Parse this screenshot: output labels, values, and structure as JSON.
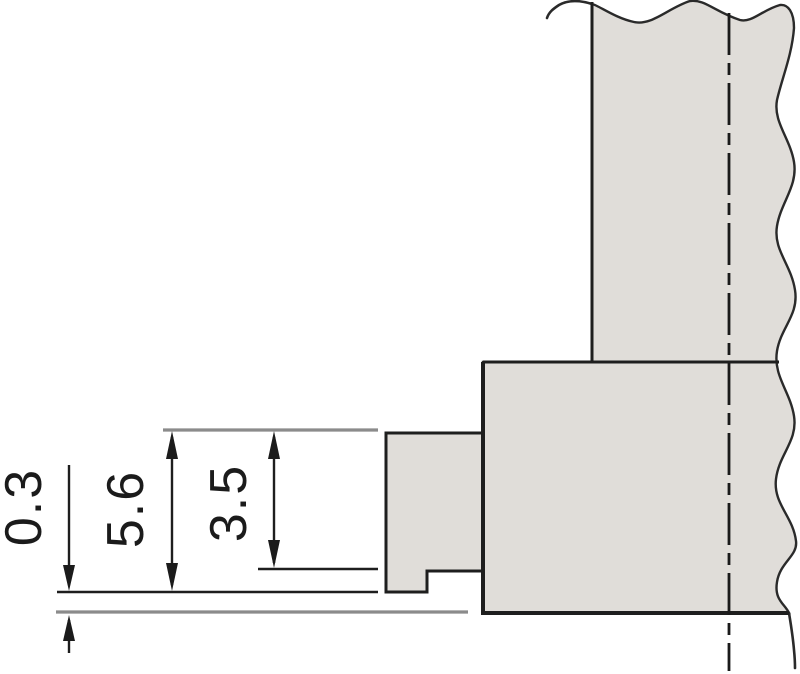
{
  "diagram": {
    "type": "technical-drawing",
    "description_visible_text_only": true,
    "dimensions": [
      {
        "id": "gap-to-surface",
        "label": "0.3"
      },
      {
        "id": "overall-height",
        "label": "5.6"
      },
      {
        "id": "step-height",
        "label": "3.5"
      }
    ],
    "colors": {
      "background": "#ffffff",
      "part_fill": "#e0ddd9",
      "outline": "#1e1e1e",
      "reference_line": "#8b8b8b",
      "text": "#1b1b1b"
    }
  }
}
